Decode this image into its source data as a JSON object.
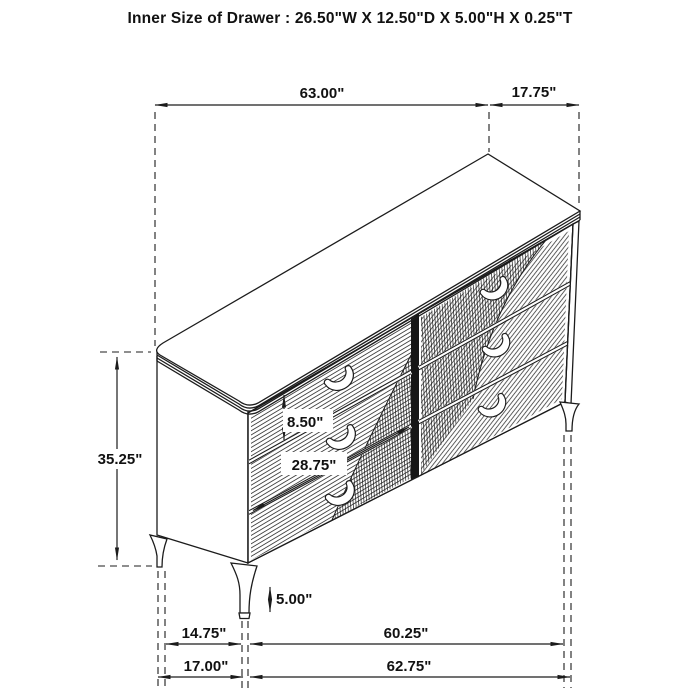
{
  "title": "Inner Size of Drawer : 26.50\"W X 12.50\"D X 5.00\"H X 0.25\"T",
  "figure": "six-drawer dresser perspective line drawing with dimensions",
  "colors": {
    "line": "#1c1c1c",
    "background": "#ffffff"
  },
  "dimensions": {
    "overall_width": "63.00\"",
    "overall_depth": "17.75\"",
    "overall_height": "35.25\"",
    "top_drawer_height": "8.50\"",
    "drawer_front_width": "28.75\"",
    "leg_height": "5.00\"",
    "leg_inset_depth": "14.75\"",
    "leg_span_width": "60.25\"",
    "base_depth": "17.00\"",
    "base_width": "62.75\""
  }
}
